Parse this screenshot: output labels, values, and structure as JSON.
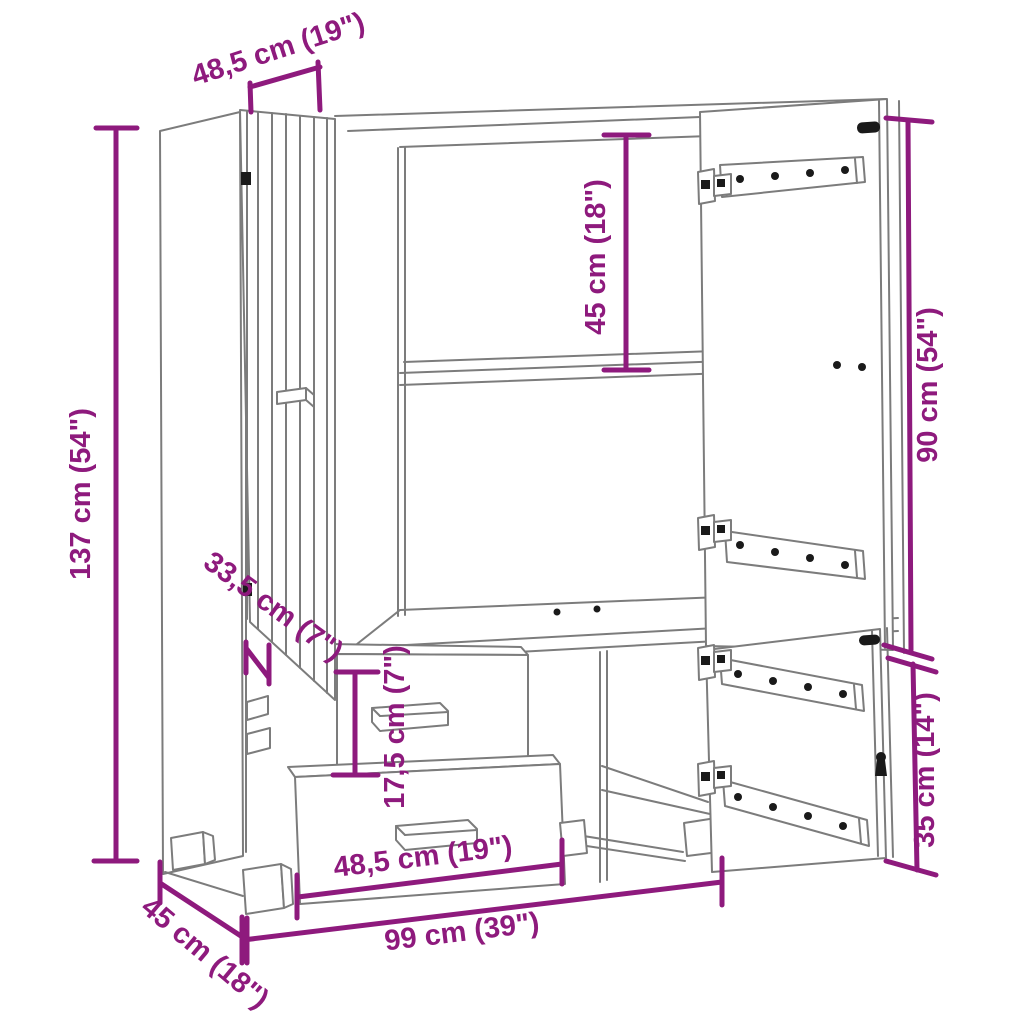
{
  "figure": {
    "subject": "wardrobe-dimension-line-drawing",
    "view": "front perspective, both doors open, two drawers"
  },
  "colors": {
    "dimension": "#8E1A7D",
    "drawing": "#7C7C7C",
    "hardware": "#1A1A1A",
    "background": "#FFFFFF"
  },
  "dimensions": {
    "top_width": "48,5 cm (19\")",
    "overall_height": "137 cm (54\")",
    "upper_compartment_height": "45 cm (18\")",
    "right_door_height": "90 cm (54\")",
    "left_door_depth": "33,5 cm (7\")",
    "drawer_height": "17,5 cm (7\")",
    "drawer_width": "48,5 cm (19\")",
    "overall_width": "99 cm (39\")",
    "overall_depth": "45 cm (18\")",
    "lower_door_height": "35 cm (14\")"
  }
}
